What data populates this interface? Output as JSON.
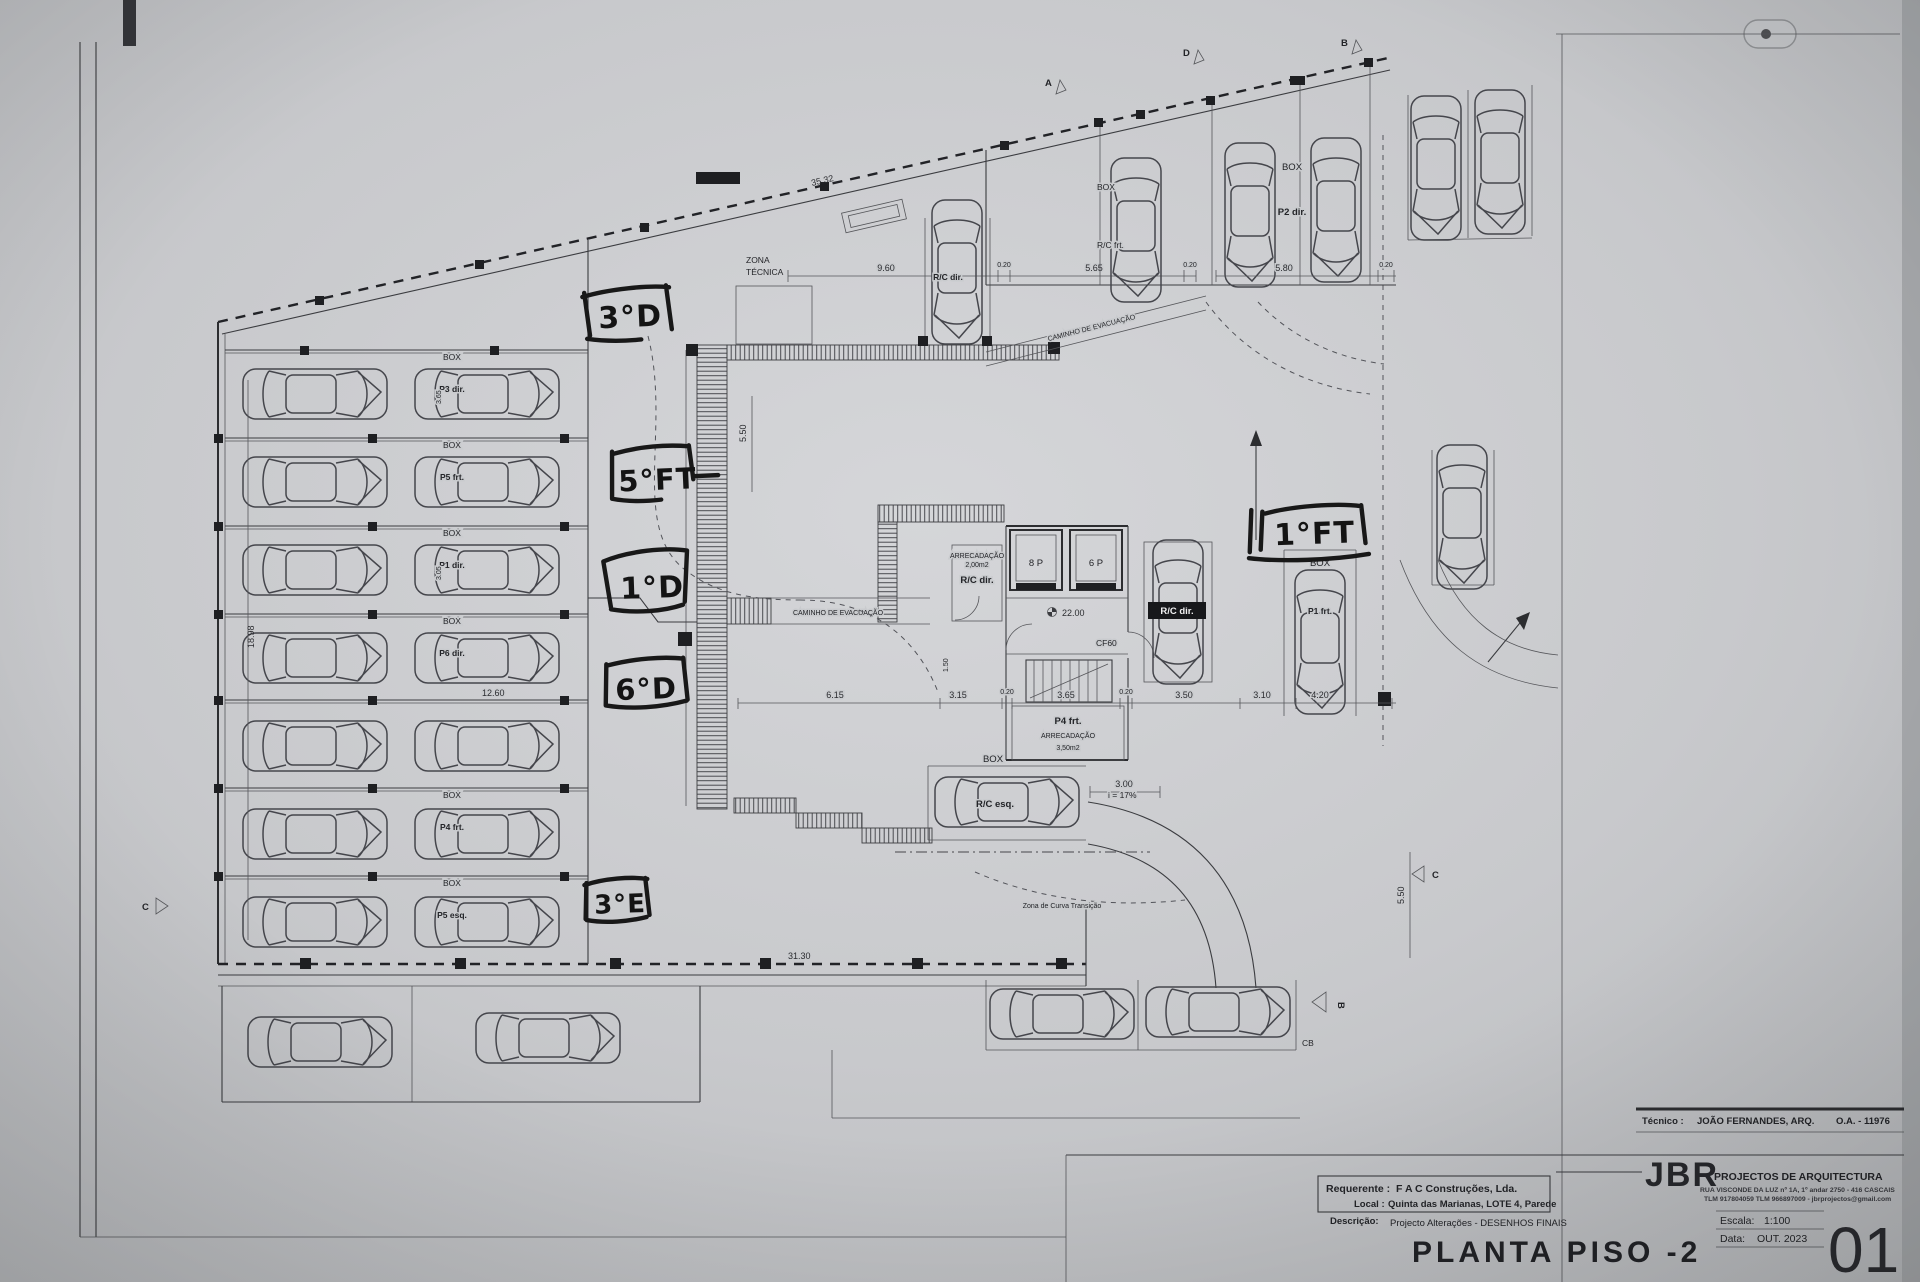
{
  "plan": {
    "box_label": "BOX",
    "zona_tecnica_line1": "ZONA",
    "zona_tecnica_line2": "TÉCNICA",
    "caminho_evacuacao": "CAMINHO DE EVACUAÇÃO",
    "stalls": {
      "p3_dir": "P3 dir.",
      "p5_frt": "P5 frt.",
      "p1_dir": "P1 dir.",
      "p6_dir": "P6 dir.",
      "p4_frt": "P4 frt.",
      "p5_esq": "P5 esq.",
      "p2_dir": "P2 dir.",
      "p1_frt": "P1 frt."
    },
    "rc_frt": "R/C frt.",
    "rc_dir": "R/C dir.",
    "rc_esq": "R/C esq.",
    "lift_8p": "8 P",
    "lift_6p": "6 P",
    "arrecadacao": "ARRECADAÇÃO",
    "arrecadacao_small_area": "2,00m2",
    "arrecadacao_big_owner": "P4 frt.",
    "arrecadacao_big_area": "3,50m2",
    "level_value": "22.00",
    "door_code": "CF60",
    "slope": "i = 17%",
    "curve_note": "Zona de Curva Transição",
    "section_a": "A",
    "section_b": "B",
    "section_c": "C",
    "section_d": "D",
    "section_cb": "CB"
  },
  "handwritten": {
    "floor_3d": "3°D",
    "floor_5ft": "5°FT",
    "floor_1d": "1°D",
    "floor_6d": "6°D",
    "floor_3e": "3°E",
    "floor_1ft": "1°FT"
  },
  "dims": {
    "top_boundary": "35.32",
    "d_960": "9.60",
    "d_565": "5.65",
    "d_020": "0.20",
    "d_580": "5.80",
    "bottom": "31.30",
    "d_615": "6.15",
    "d_315": "3.15",
    "d_365": "3.65",
    "d_350": "3.50",
    "d_310": "3.10",
    "d_420": "4.20",
    "d_1260": "12.60",
    "d_1898": "18.98",
    "d_300": "3.00",
    "d_550": "5.50",
    "d_150": "1.50",
    "d_305": "3.05"
  },
  "title_block": {
    "tecnico_label": "Técnico :",
    "tecnico_name": "JOÃO FERNANDES, ARQ.",
    "tecnico_number": "O.A. - 11976",
    "firm_initials": "JBR",
    "firm_name": "PROJECTOS DE ARQUITECTURA",
    "firm_address": "RUA VISCONDE DA LUZ nº 1A, 1º andar  2750 - 416  CASCAIS",
    "firm_contacts": "TLM 917804059  TLM 966897009 - jbrprojectos@gmail.com",
    "requerente_label": "Requerente :",
    "requerente_value": "F A C  Construções, Lda.",
    "local_label": "Local :",
    "local_value": "Quinta das Marianas, LOTE 4, Parede",
    "descricao_label": "Descrição:",
    "descricao_value": "Projecto Alterações - DESENHOS FINAIS",
    "drawing_title": "PLANTA PISO -2",
    "escala_label": "Escala:",
    "escala_value": "1:100",
    "data_label": "Data:",
    "data_value": "OUT. 2023",
    "sheet_number": "01"
  }
}
